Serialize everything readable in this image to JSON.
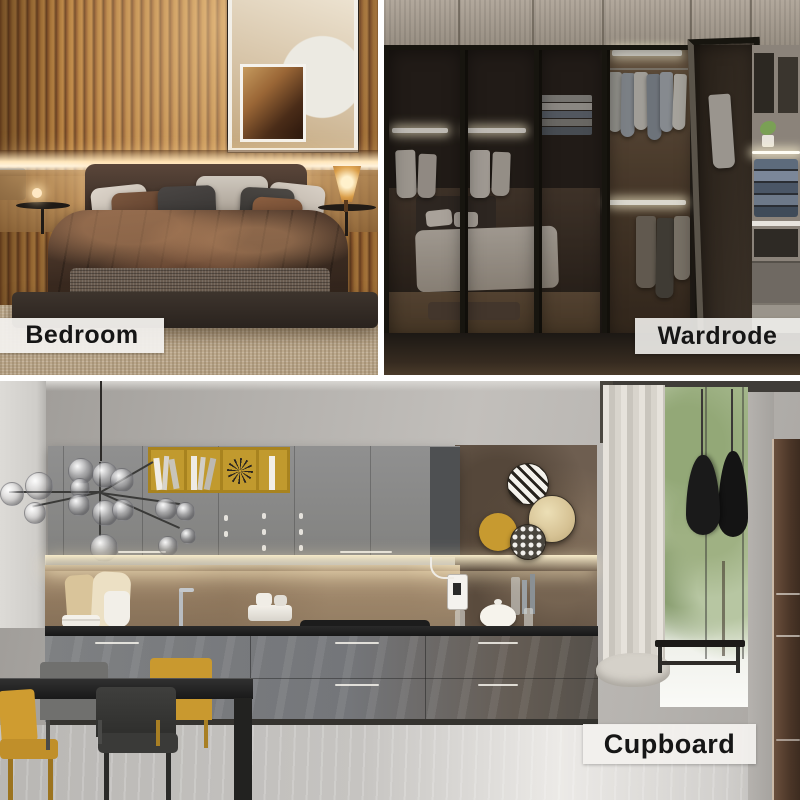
{
  "page": {
    "type": "interior-design-photo-collage",
    "grid": "two-top-one-bottom"
  },
  "labels": {
    "bedroom": "Bedroom",
    "wardrobe": "Wardrode",
    "cupboard": "Cupboard"
  },
  "sections": [
    {
      "id": "bedroom",
      "caption": "Bedroom",
      "position": "top-left"
    },
    {
      "id": "wardrobe",
      "caption": "Wardrode",
      "position": "top-right"
    },
    {
      "id": "cupboard",
      "caption": "Cupboard",
      "position": "bottom"
    }
  ],
  "colors": {
    "divider": "#ffffff",
    "label_bg": "#f1efec",
    "label_text": "#161616",
    "bedroom_wood": "#a96f3a",
    "led_glow": "#ffe7bc",
    "wardrobe_frame": "#17150f",
    "mustard_accent": "#c79b30",
    "cabinet_gray": "#85878a",
    "backsplash_tan": "#a98e6d",
    "countertop": "#1a1a1a",
    "curtain": "#d8d4cc",
    "foliage_green": "#9cae80",
    "floor_gray": "#c6c4c1",
    "right_cabinet_brown": "#553c2b"
  }
}
